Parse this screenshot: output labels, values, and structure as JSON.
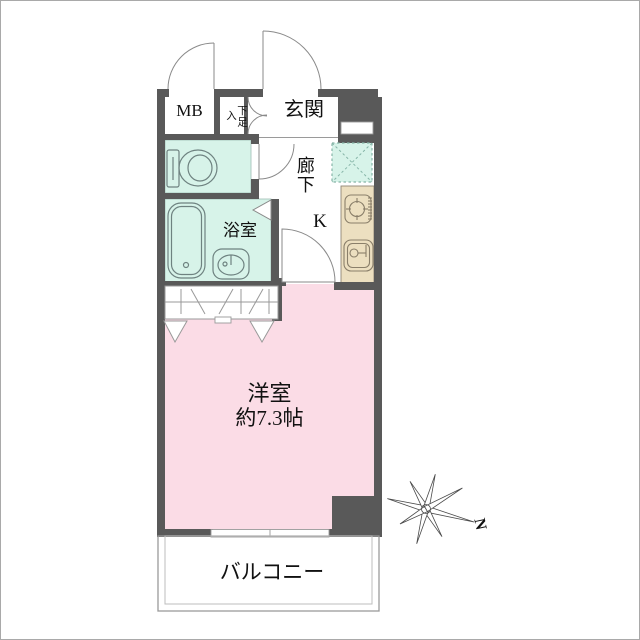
{
  "labels": {
    "meter_box": "MB",
    "shoe_storage": "下足入",
    "entrance": "玄関",
    "hallway": "廊下",
    "kitchen": "K",
    "bathroom": "浴室",
    "main_room": "洋室",
    "main_room_size": "約7.3帖",
    "balcony": "バルコニー",
    "compass_north": "N"
  },
  "colors": {
    "wall": "#595959",
    "room_pink": "#fbdce6",
    "wet_area_mint": "#d7f3e9",
    "kitchen_beige": "#ecdfc0"
  }
}
